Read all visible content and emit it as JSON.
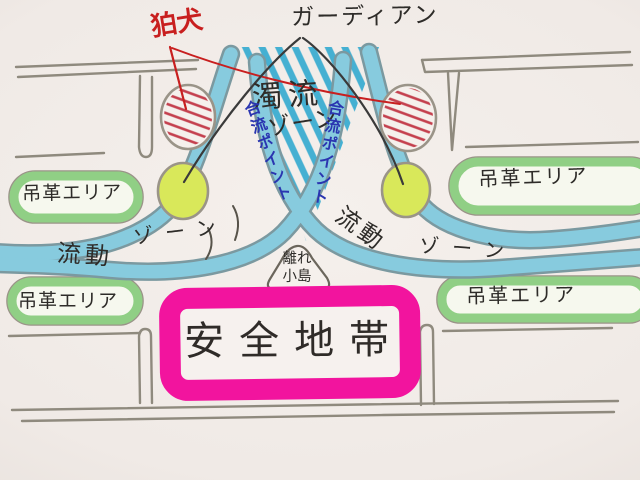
{
  "diagram": {
    "description": "hand-drawn crowd-flow map of a station platform drawn like a river",
    "labels": {
      "guardian": "ガーディアン",
      "komainu": "狛犬",
      "turbulent_zone": {
        "line1": "濁流",
        "line2": "ゾーン"
      },
      "merge_point_left": "合流ポイント",
      "merge_point_right": "合流ポイント",
      "flow_zone_left": {
        "part1": "流動",
        "part2": "ゾーン"
      },
      "flow_zone_right": {
        "part1": "流動",
        "part2": "ゾーン"
      },
      "isolated_island": {
        "line1": "離れ",
        "line2": "小島"
      },
      "safety_zone": "安全地帯",
      "strap_areas": [
        {
          "id": "top-left",
          "label": "吊革エリア"
        },
        {
          "id": "top-right",
          "label": "吊革エリア"
        },
        {
          "id": "bottom-left",
          "label": "吊革エリア"
        },
        {
          "id": "bottom-right",
          "label": "吊革エリア"
        }
      ]
    },
    "colors": {
      "paper": "#f0eae6",
      "river_fill": "#87cbde",
      "river_edge": "#7b99a0",
      "hatch_cyan": "#45b0d2",
      "strap_green": "#90cf85",
      "guardian_circle_green": "#d9e85a",
      "komainu_hatch_red": "#c4404e",
      "safety_pink": "#f2149e",
      "merge_text_blue": "#2a35b0",
      "komainu_text_red": "#c81f1f",
      "ink": "#2e2c29",
      "pencil_gray": "#8f8a7e"
    }
  }
}
